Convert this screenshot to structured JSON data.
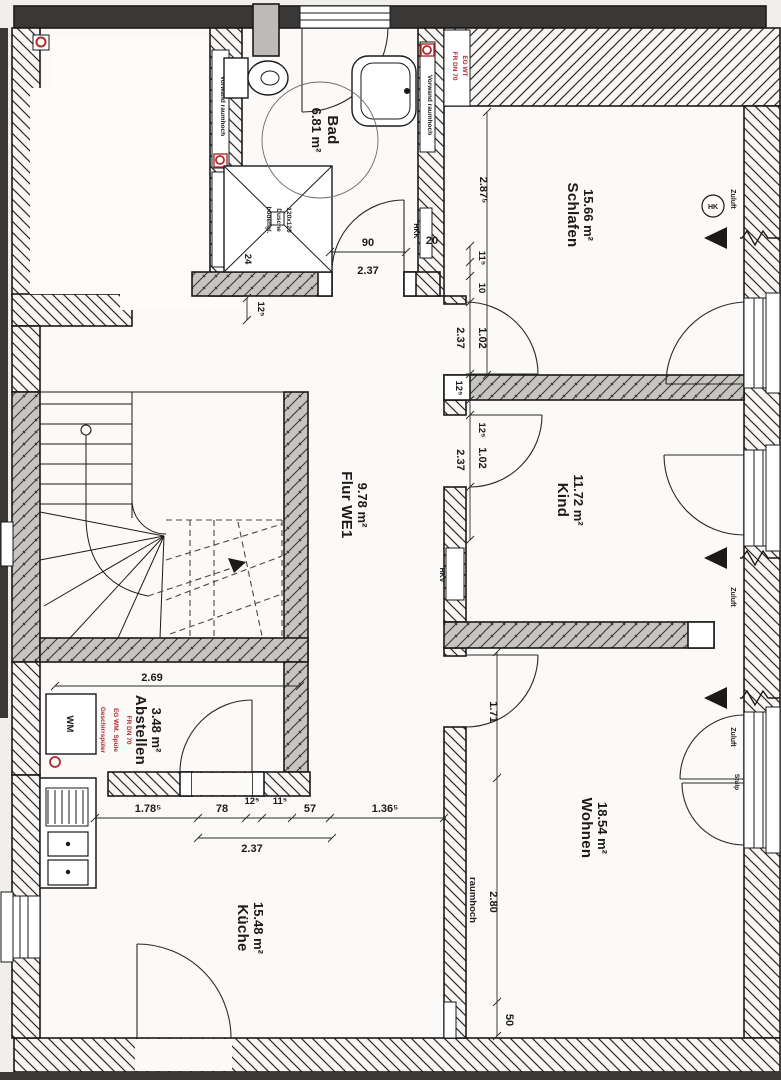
{
  "plan": {
    "rooms": {
      "bad": {
        "name": "Bad",
        "area": "6.81 m²"
      },
      "schlafen": {
        "name": "Schlafen",
        "area": "15.66 m²"
      },
      "kind": {
        "name": "Kind",
        "area": "11.72 m²"
      },
      "flur": {
        "name": "Flur WE1",
        "area": "9.78 m²"
      },
      "abstellen": {
        "name": "Abstellen",
        "area": "3.48 m²"
      },
      "wohnen": {
        "name": "Wohnen",
        "area": "18.54 m²"
      },
      "kueche": {
        "name": "Küche",
        "area": "15.48 m²"
      }
    },
    "fixtures": {
      "shower_l1": "bodengl.",
      "shower_l2": "Dusche",
      "shower_l3": "120x120",
      "wm": "WM"
    },
    "notes": {
      "vorwand_left": "Vorwand raumhoch",
      "vorwand_right": "Vorwand raumhoch",
      "shaft_bad_l1": "FR DN 70",
      "shaft_bad_l2": "EG WT",
      "shaft_abst_l1": "FR DN 70",
      "shaft_abst_l2": "EG WM. Spüle",
      "shaft_abst_l3": "Geschirrspüler",
      "hkv": "HKV",
      "hkk": "HKK",
      "hk": "HK",
      "zuluft": "Zuluft",
      "stulp": "Stulp",
      "raumhoch": "raumhoch"
    },
    "dims": {
      "d90": "90",
      "d237a": "2.37",
      "d20": "20",
      "d24": "24",
      "d125_shower": "12⁵",
      "d2875": "2.87⁵",
      "sd1": "11⁵",
      "sd2": "10",
      "sd3": "1.02",
      "sd_total": "2.37",
      "kd0": "12⁵",
      "kd1": "12⁵",
      "kd2": "1.02",
      "kd_total": "2.37",
      "d269": "2.69",
      "bc1": "1.78⁵",
      "bc2": "78",
      "bc3": "12⁵",
      "bc4": "11⁵",
      "bc5": "57",
      "bc6": "1.36⁵",
      "bc_total": "2.37",
      "d171": "1.71",
      "d280": "2.80",
      "d50": "50"
    },
    "colors": {
      "annotation_red": "#b02a2e",
      "wall_grey": "#c7c5c2",
      "wall_dark": "#3a3836",
      "line": "#1b1a19"
    }
  }
}
